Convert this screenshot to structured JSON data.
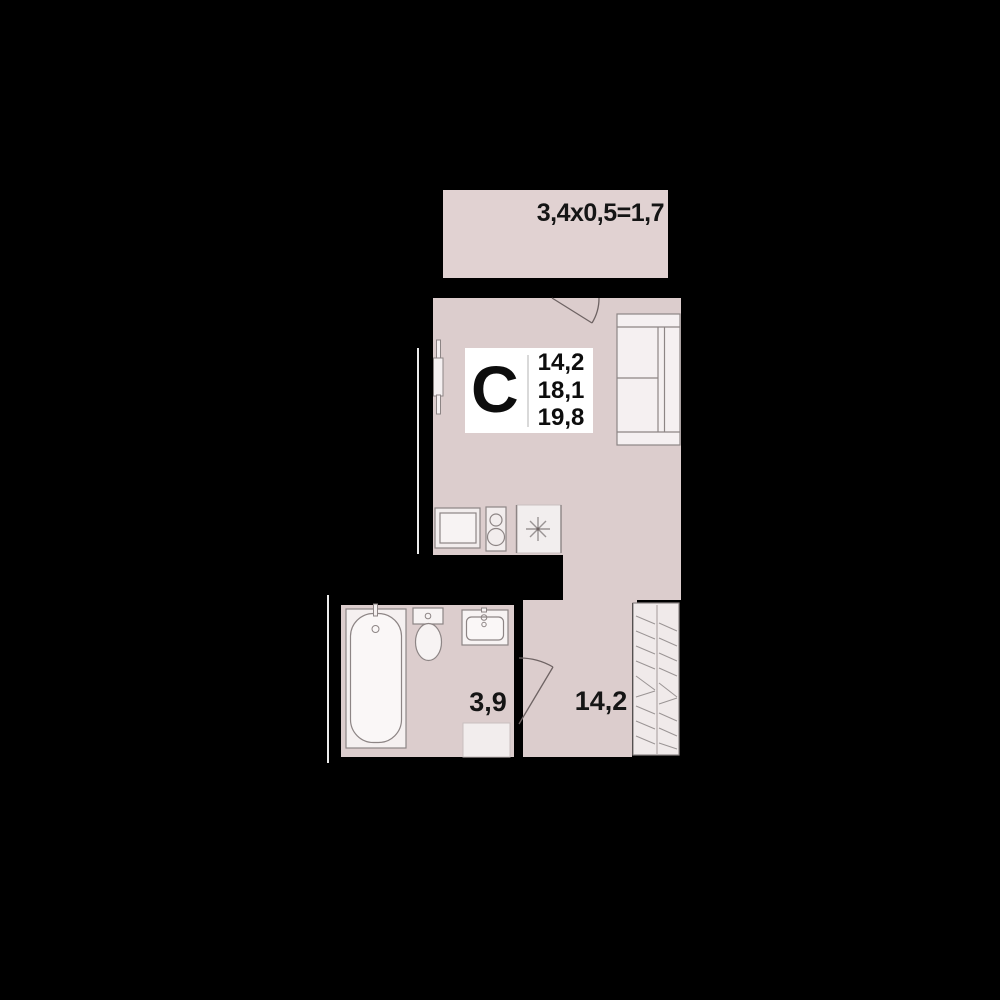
{
  "plan": {
    "unit_letter": "C",
    "areas": {
      "living": "14,2",
      "total": "18,1",
      "total_with_balcony": "19,8"
    },
    "balcony_dimensions": "3,4x0,5=1,7",
    "bathroom_area": "3,9",
    "room_area": "14,2"
  },
  "colors": {
    "background": "#000000",
    "room_fill": "#dccdcd",
    "balcony_fill": "#e1d2d2",
    "fixture_fill": "#f5f0f1",
    "wardrobe_fill": "#f0eaea",
    "outline": "#8d8585",
    "door_arc": "#6e6363",
    "badge_bg": "#ffffff",
    "badge_divider": "#d9d9d9",
    "text": "#151515",
    "neighbor_wall_line": "#ececec",
    "hatch_line": "#9a9494"
  },
  "icons": {
    "sofa": "sofa-icon",
    "bathtub": "bathtub-icon",
    "toilet": "toilet-icon",
    "washbasin": "washbasin-icon",
    "kitchen_sink": "kitchen-sink-icon",
    "stove": "stove-icon",
    "vent_asterisk": "vent-asterisk-icon",
    "wardrobe_hatch": "wardrobe-hatch-icon",
    "radiator": "radiator-icon",
    "door_swing": "door-swing-icon"
  }
}
